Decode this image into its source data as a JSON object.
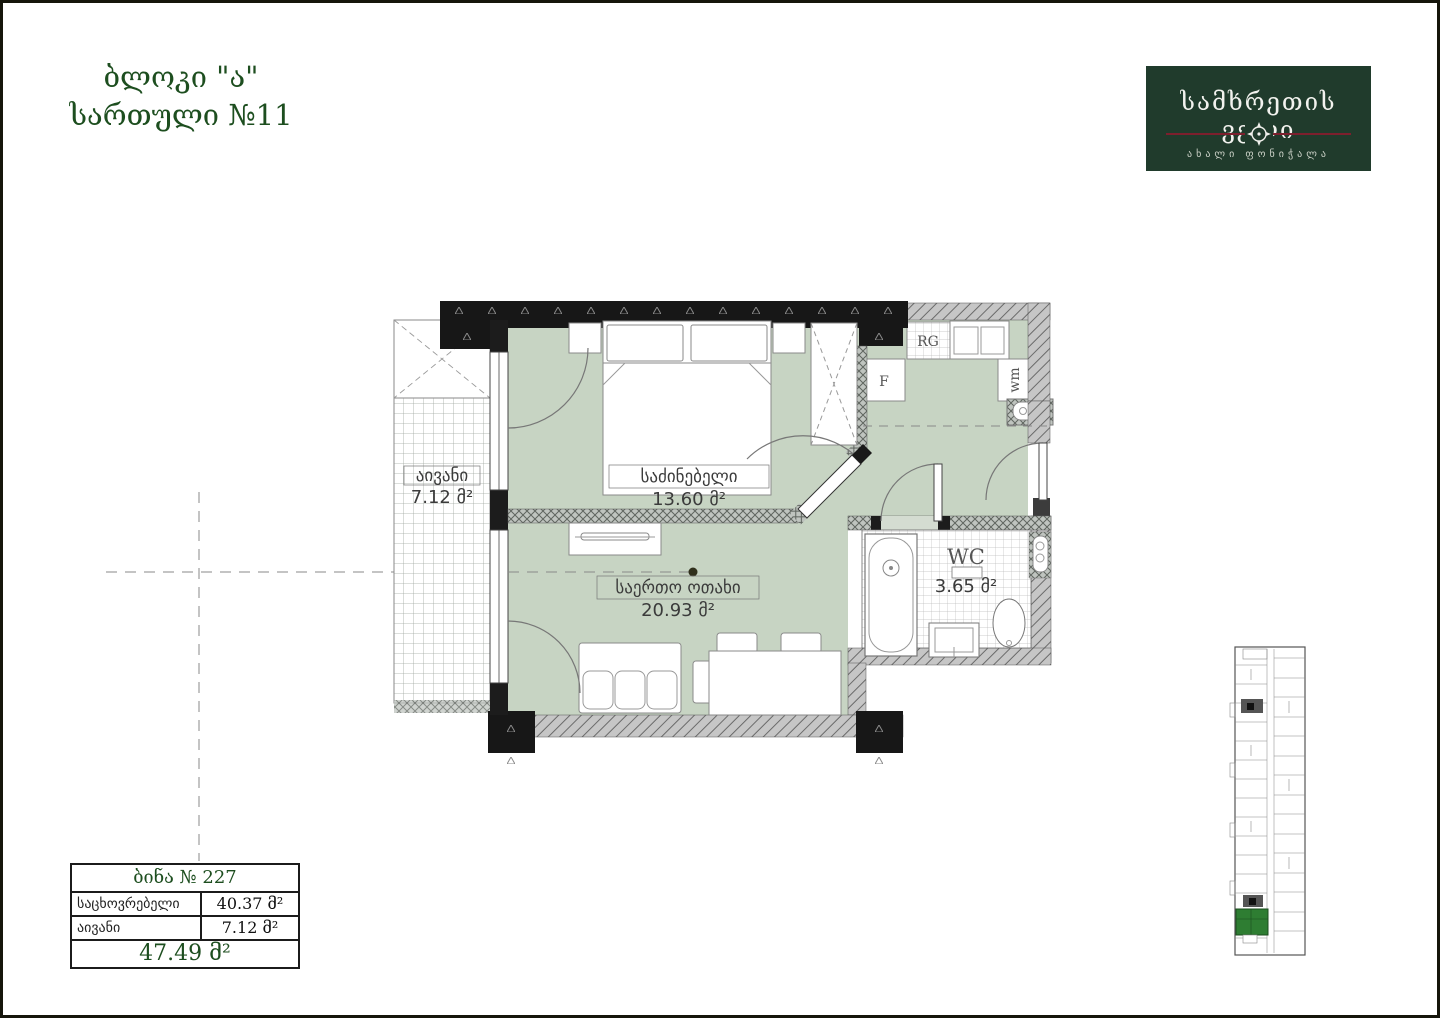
{
  "header": {
    "block_title": "ბლოკი \"ა\"",
    "floor_title": "სართული №11"
  },
  "logo": {
    "title": "სამხრეთის ველი",
    "subtitle": "ახალი ფონიჭალა"
  },
  "plan": {
    "rooms": {
      "balcony": {
        "name": "აივანი",
        "area": "7.12 მ²"
      },
      "bedroom": {
        "name": "საძინებელი",
        "area": "13.60 მ²"
      },
      "living": {
        "name": "საერთო ოთახი",
        "area": "20.93 მ²"
      },
      "wc": {
        "name": "WC",
        "area": "3.65 მ²"
      }
    },
    "appliances": {
      "range": "RG",
      "fridge": "F",
      "washer": "wm"
    }
  },
  "info_table": {
    "title": "ბინა № 227",
    "rows": [
      {
        "label": "საცხოვრებელი",
        "value": "40.37 მ²"
      },
      {
        "label": "აივანი",
        "value": "7.12 მ²"
      }
    ],
    "total": "47.49 მ²"
  },
  "colors": {
    "title_green": "#1d4e1f",
    "logo_bg": "#203b2c",
    "logo_line_red": "#7d1f2d",
    "room_fill": "#c7d4c3",
    "unit_highlight": "#2e7d32"
  }
}
